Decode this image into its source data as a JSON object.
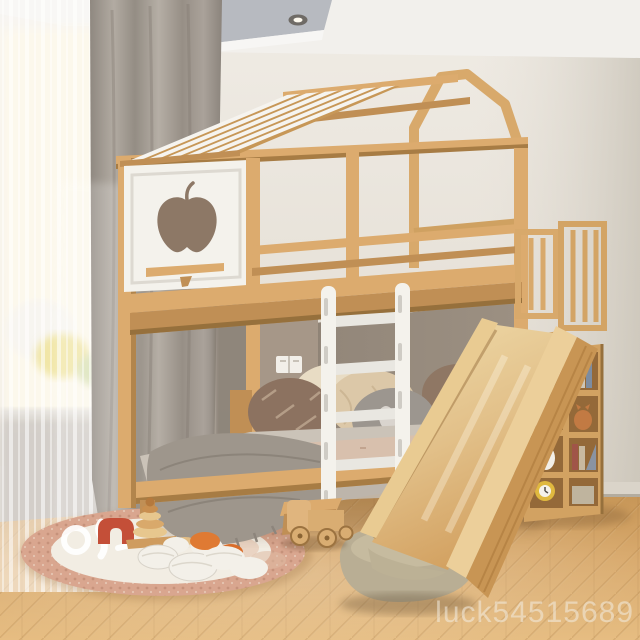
{
  "watermark": {
    "text": "luck54515689",
    "color": "rgba(243,236,225,0.55)"
  },
  "palette": {
    "wood": "#dcab6e",
    "wood_dark": "#c08f55",
    "wood_deep": "#9c7340",
    "wood_light": "#efd3a0",
    "white_paint": "#f4f2ec",
    "roof_slat_white": "#f6f4ef",
    "wall": "#e9e4dc",
    "wall_right": "#d5cfc4",
    "ceiling_tray_gray": "#b7bac0",
    "alcove_wall_taupe": "#93877a",
    "headboard_taupe": "#a69788",
    "curtain_gray": "#a39c93",
    "window_glow": "#fbf2da",
    "floor_oak": "#d4a266",
    "rug_border_blush": "#d9a68f",
    "rug_center": "#f2ede3",
    "mattress_gray": "#cbc3b8",
    "blanket_blush": "#d8c0ad",
    "throw_knit_gray": "#9e968c",
    "slide_cushion_beige": "#b9ae94",
    "apple_cutout_shadow": "#8d7866",
    "toy_orange": "#df7a33",
    "toy_red": "#c44f38",
    "pebble_white": "#f3f0e9"
  }
}
